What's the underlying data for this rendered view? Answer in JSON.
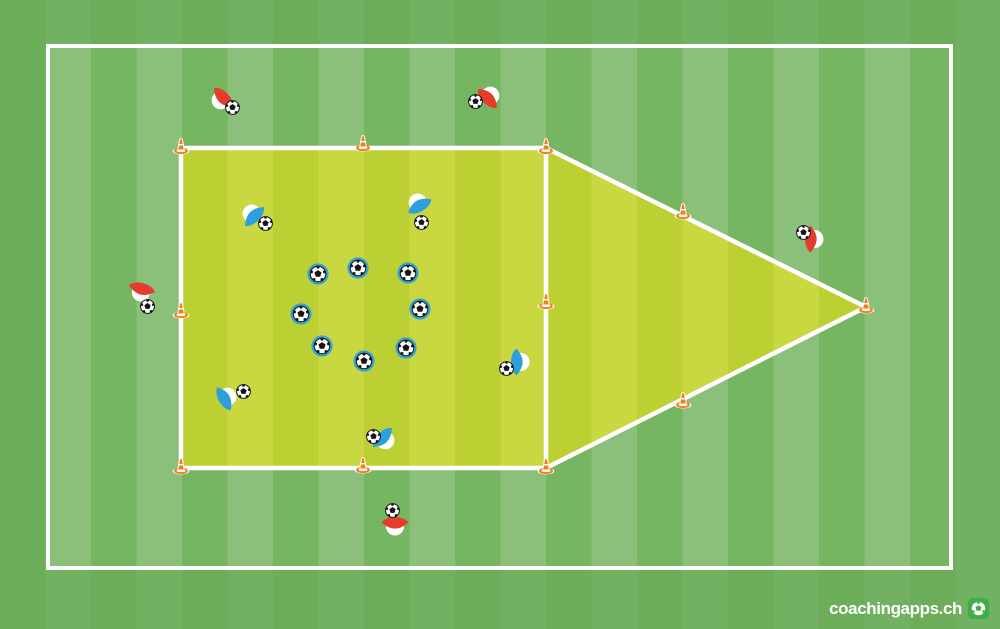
{
  "app": {
    "logo_text": "coachingapps.ch"
  },
  "canvas": {
    "width": 1000,
    "height": 629
  },
  "colors": {
    "field_dark": "#76b561",
    "field_light": "#8bc07a",
    "margin_overlay": "rgba(104,170,88,0.72)",
    "zone_dark": "#bdd033",
    "zone_light": "#c9d741",
    "line": "#ffffff",
    "red": "#e73b2c",
    "blue": "#2d9fdd",
    "ring": "#2ea3dc",
    "cone": "#f08019",
    "logo_green": "#3fae49",
    "ball_dark": "#151515",
    "ball_light": "#fdfdfd"
  },
  "field": {
    "stripe_width": 45.5,
    "boundary": {
      "x": 46,
      "y": 44,
      "w": 907,
      "h": 526
    }
  },
  "drill": {
    "zone_square": {
      "x1": 181,
      "y1": 148,
      "x2": 546,
      "y2": 468
    },
    "zone_triangle_apex": {
      "x": 866,
      "y": 307
    },
    "cones": [
      {
        "x": 181,
        "y": 147
      },
      {
        "x": 363,
        "y": 144
      },
      {
        "x": 546,
        "y": 147
      },
      {
        "x": 181,
        "y": 311
      },
      {
        "x": 546,
        "y": 302
      },
      {
        "x": 181,
        "y": 467
      },
      {
        "x": 363,
        "y": 466
      },
      {
        "x": 546,
        "y": 467
      },
      {
        "x": 683,
        "y": 212
      },
      {
        "x": 866,
        "y": 306
      },
      {
        "x": 683,
        "y": 401
      }
    ],
    "players": [
      {
        "team": "red",
        "x": 221,
        "y": 100,
        "rot": 135,
        "ball": {
          "x": 232,
          "y": 107
        }
      },
      {
        "team": "red",
        "x": 490,
        "y": 96,
        "rot": -45,
        "ball": {
          "x": 475,
          "y": 101
        }
      },
      {
        "team": "red",
        "x": 141,
        "y": 292,
        "rot": 105,
        "ball": {
          "x": 147,
          "y": 306
        }
      },
      {
        "team": "red",
        "x": 814,
        "y": 239,
        "rot": 0,
        "ball": {
          "x": 803,
          "y": 232
        }
      },
      {
        "team": "red",
        "x": 395,
        "y": 526,
        "rot": 90,
        "ball": {
          "x": 392,
          "y": 510
        }
      },
      {
        "team": "blue",
        "x": 252,
        "y": 214,
        "rot": -135,
        "ball": {
          "x": 265,
          "y": 223
        }
      },
      {
        "team": "blue",
        "x": 418,
        "y": 203,
        "rot": -120,
        "ball": {
          "x": 421,
          "y": 222
        }
      },
      {
        "team": "blue",
        "x": 227,
        "y": 397,
        "rot": -30,
        "ball": {
          "x": 243,
          "y": 391
        }
      },
      {
        "team": "blue",
        "x": 385,
        "y": 440,
        "rot": 45,
        "ball": {
          "x": 373,
          "y": 436
        }
      },
      {
        "team": "blue",
        "x": 520,
        "y": 362,
        "rot": 0,
        "ball": {
          "x": 506,
          "y": 368
        }
      }
    ],
    "loose_balls": [
      {
        "x": 318,
        "y": 274
      },
      {
        "x": 358,
        "y": 268
      },
      {
        "x": 408,
        "y": 273
      },
      {
        "x": 301,
        "y": 314
      },
      {
        "x": 420,
        "y": 309
      },
      {
        "x": 322,
        "y": 346
      },
      {
        "x": 364,
        "y": 361
      },
      {
        "x": 406,
        "y": 348
      }
    ]
  }
}
